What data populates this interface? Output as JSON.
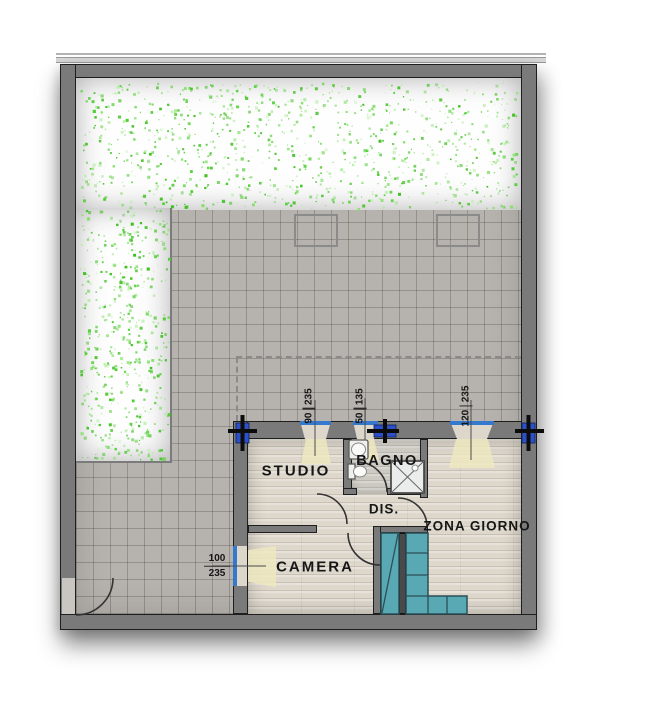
{
  "rooms": {
    "studio": "STUDIO",
    "bagno": "BAGNO",
    "dis": "DIS.",
    "camera": "CAMERA",
    "zona_giorno": "ZONA GIORNO"
  },
  "window_dimensions": {
    "studio": {
      "width": "90",
      "height": "235"
    },
    "bagno": {
      "width": "50",
      "height": "135"
    },
    "zona_giorno": {
      "width": "120",
      "height": "235"
    },
    "camera": {
      "width": "100",
      "height": "235"
    }
  },
  "colors": {
    "wall": "#7a7a7a",
    "tile": "#b6b3ae",
    "parquet": "#ddd7cc",
    "teal": "#58a9b3",
    "window_blue": "#3579cf",
    "column_blue": "#2b50c8",
    "light_cone": "#efe8c0",
    "garden_dot": "#3ec01e"
  }
}
